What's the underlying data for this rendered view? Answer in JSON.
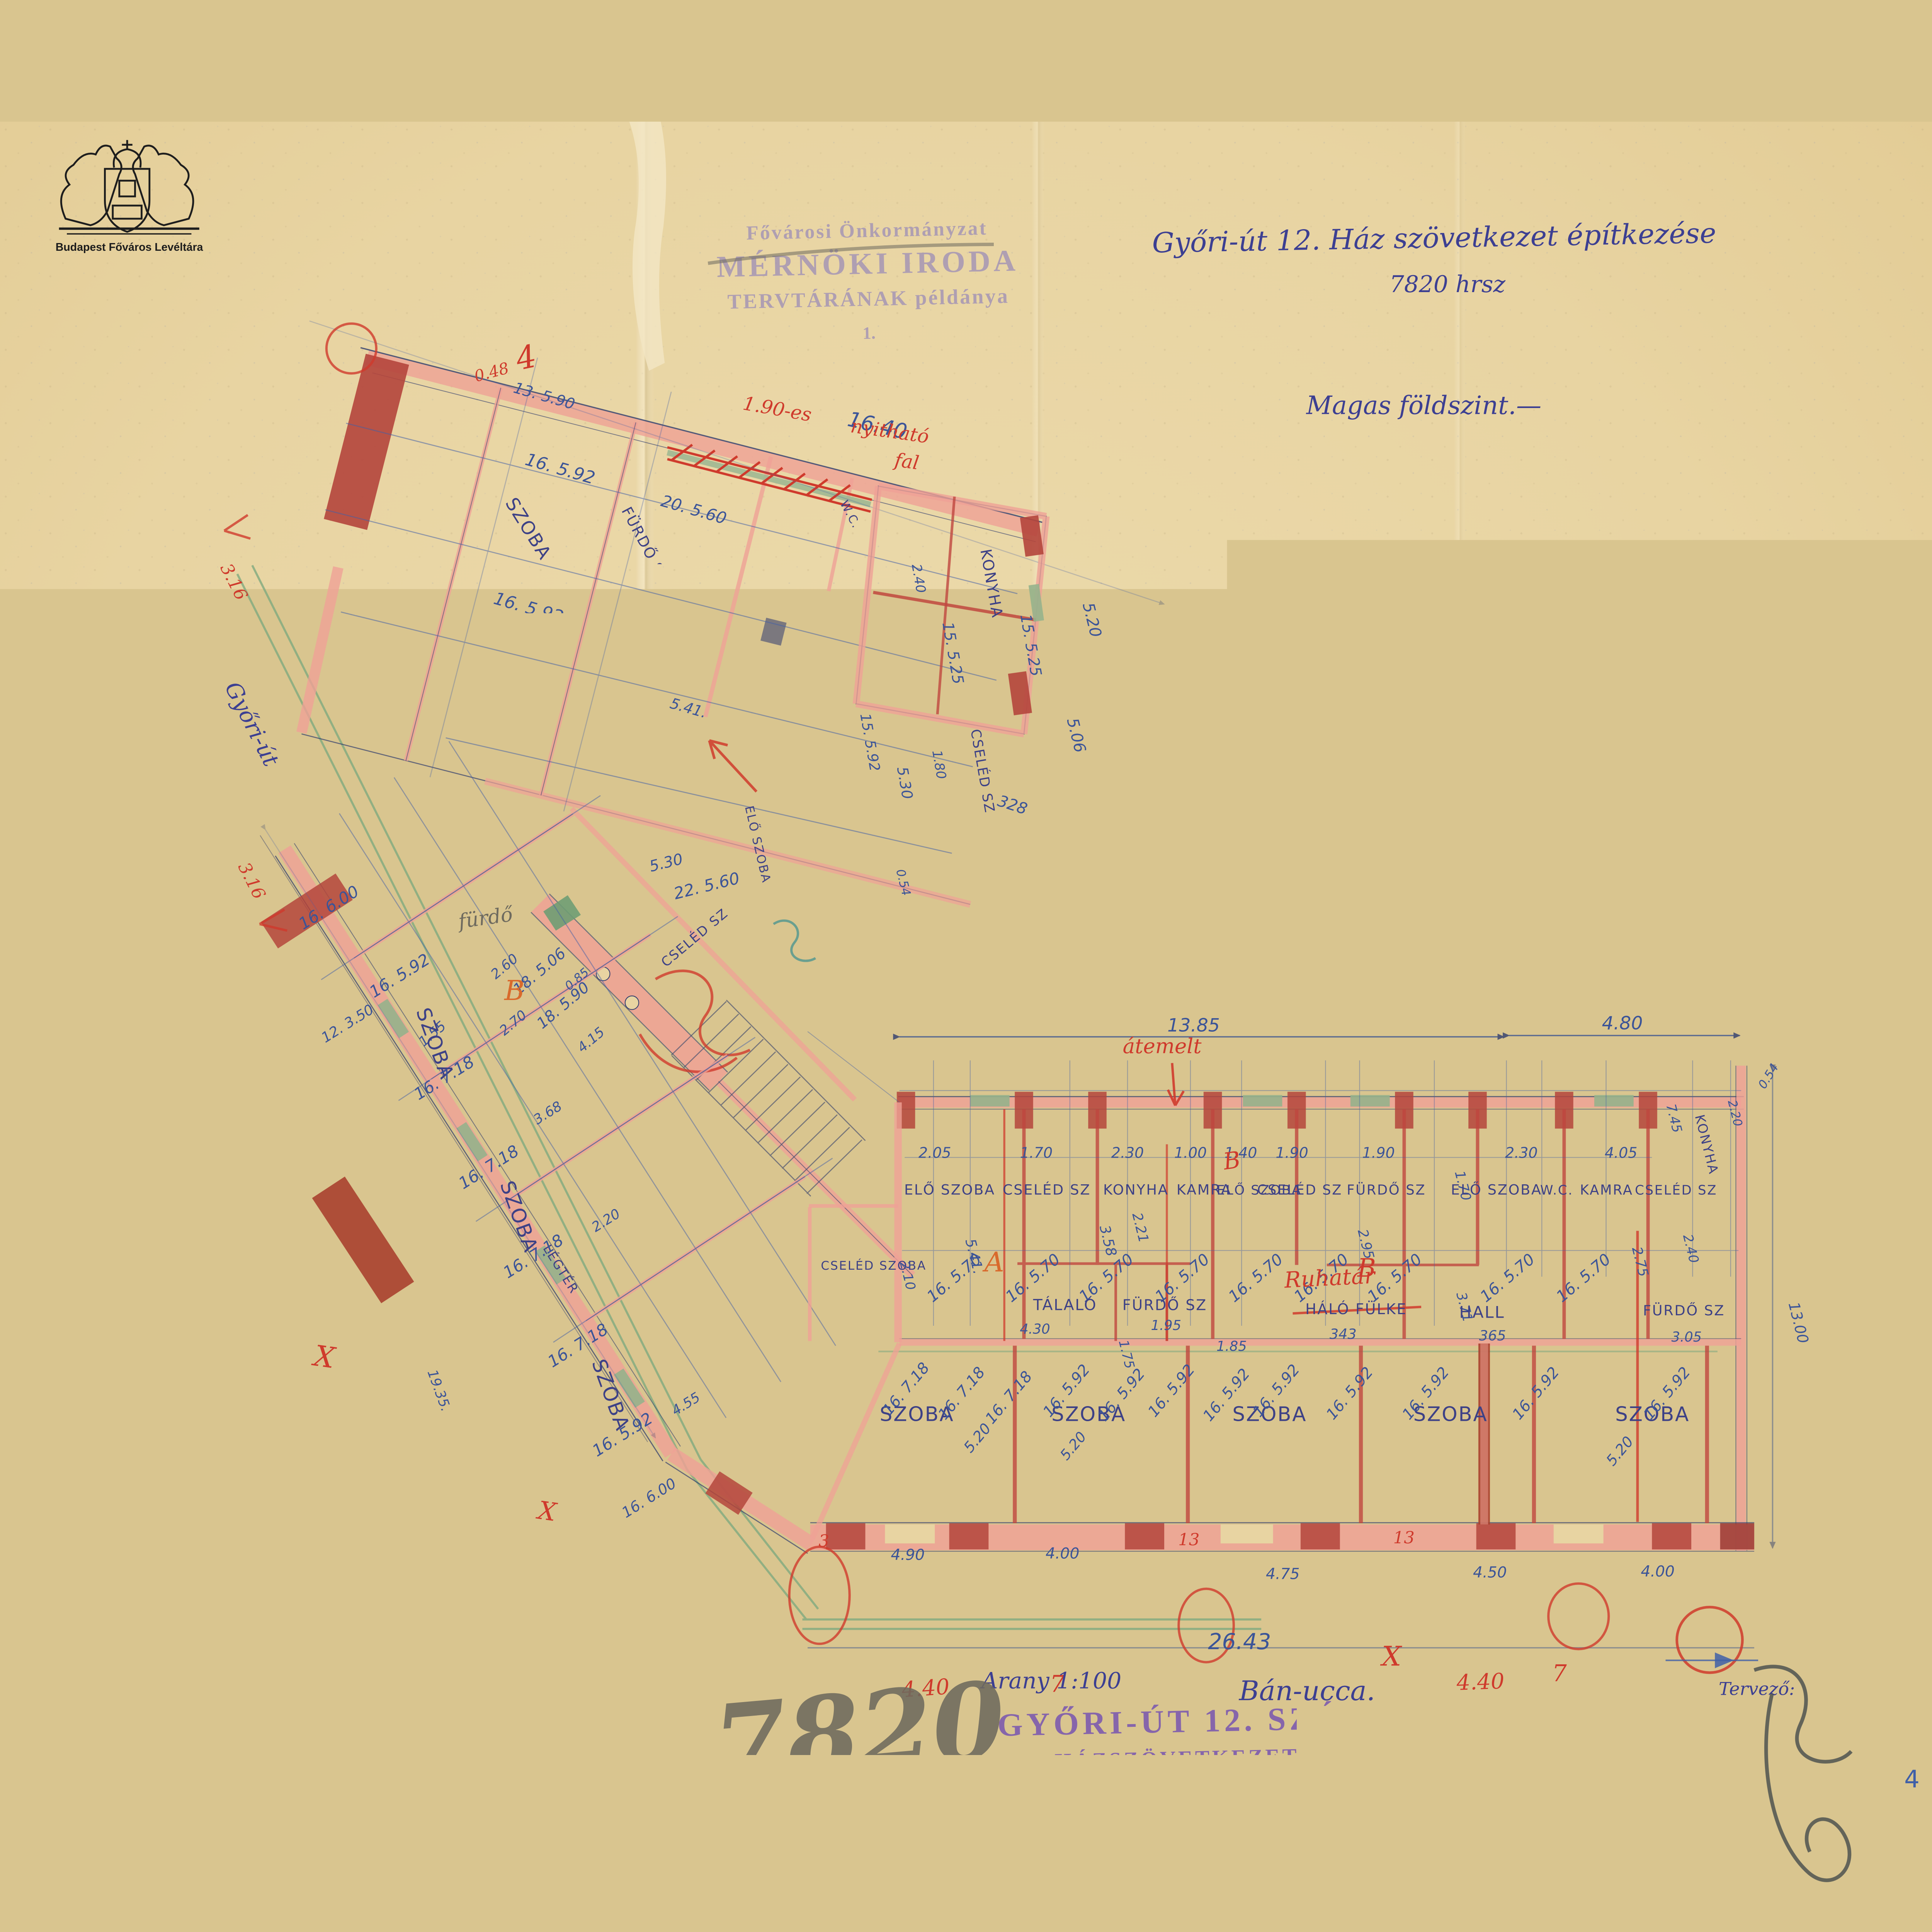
{
  "doc": {
    "archive": "Budapest Főváros Levéltára",
    "stamp1": "Fővárosi Önkormányzat",
    "stamp2": "MÉRNÖKI IRODA",
    "stamp3": "TERVTÁRÁNAK példánya",
    "stamp4": "1.",
    "title": "Győri-út 12. Ház szövetkezet építkezése",
    "parcel": "7820 hrsz",
    "floor": "Magas földszint.—",
    "scale": "Arany 1:100",
    "street2": "Bán-ucca.",
    "ostamp1": "GYŐRI-ÚT 12. SZÁMU",
    "ostamp2": "HÁZSZÖVETKEZET.",
    "master": "Felelős ép mester:",
    "designer": "Tervező:",
    "bignum": "7820",
    "page": "4"
  },
  "room": {
    "szoba": "SZOBA",
    "konyha": "KONYHA",
    "kamra": "KAMRA",
    "cseled": "CSELÉD SZ",
    "cseledszoba": "CSELÉD SZOBA",
    "elo": "ELŐ SZOBA",
    "furdo": "FÜRDŐ SZ",
    "wc": "W.C.",
    "hall": "HALL",
    "talalo": "TÁLALÓ",
    "halofulke": "HÁLÓ FÜLKE",
    "loggia": "LOGGIA",
    "legter": "LÉGTÉR",
    "gyoriut": "Győri-út"
  },
  "dim": {
    "a": "13. 5.90",
    "b": "16.40",
    "c": "16. 5.92",
    "d": "16. 7.18",
    "e": "20. 5.60",
    "f": "18. 5.60",
    "g": "18. 3.70",
    "h": "15. 5.25",
    "i": "328",
    "j": "2.40",
    "k": "1.80",
    "l": "0.54",
    "m": "5.20",
    "n": "5.06",
    "o": "5.30",
    "p": "22. 5.60",
    "q": "16. 6.90",
    "r": "16. 6.00",
    "s": "12. 3.50",
    "t": "3.90",
    "u": "18.96",
    "v": "2.60",
    "w": "18. 5.06",
    "x": "18. 5.90",
    "y": "2.70",
    "z": "1.55",
    "aa": "0.85",
    "ab": "4.15",
    "ac": "19.35.",
    "ad": "3.68",
    "ae": "2.20",
    "af": "4.55",
    "ag": "2.05",
    "ah": "1.70",
    "ai": "2.30",
    "aj": "1.00",
    "ak": "1.40",
    "al": "1.90",
    "am": "4.05",
    "an": "2.21",
    "ao": "2.95",
    "ap": "3.71",
    "aq": "2.75",
    "ar": "5.41.",
    "as": "3.58",
    "at": "16. 5.70",
    "au": "1.95",
    "av": "1.85",
    "aw": "4.30",
    "ax": "1.75",
    "ay": "343",
    "az": "365",
    "ba": "3.05",
    "bb": "4.90",
    "bc": "4.00",
    "bd": "4.75",
    "be": "4.50",
    "bf": "26.43",
    "bg": "13.85",
    "bh": "4.80",
    "bi": "7.45",
    "bj": "13.00",
    "bk": "2.10",
    "bl": "15. 5.92"
  },
  "red": {
    "n1": "1.90-es",
    "n2": "nyitható",
    "n3": "fal",
    "A": "A",
    "B": "B",
    "X": "X",
    "c3": "3",
    "c13": "13",
    "s7": "7",
    "d440": "4.40",
    "d316": "3.16",
    "d048": "0.48",
    "n4": "4",
    "ruhatar": "Ruhatár",
    "atemelt": "átemelt"
  },
  "pencil": {
    "furdo": "fürdő"
  }
}
